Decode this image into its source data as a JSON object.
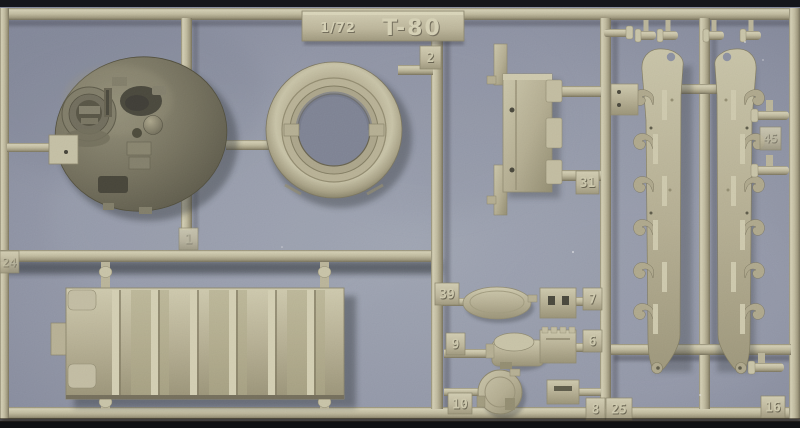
{
  "photo": {
    "subject": "Injection-molded plastic model kit sprue with T-80 tank parts on a gray-blue scanner background",
    "title_plate": {
      "scale": "1/72",
      "name": "T-80"
    },
    "part_tags": {
      "t1": "1",
      "t2": "2",
      "t6": "6",
      "t7": "7",
      "t8": "8",
      "t9": "9",
      "t10": "10",
      "t16": "16",
      "t24": "24",
      "t25": "25",
      "t31": "31",
      "t39": "39",
      "t45": "45"
    },
    "colors": {
      "background": "#8f94a5",
      "plastic": "#b7b194",
      "plastic_highlight": "#d6d1b3",
      "plastic_shadow": "#756f56",
      "turret_plastic": "#6c6853"
    },
    "parts": [
      "turret-roof",
      "turret-ring",
      "hull-rear-bulkhead",
      "ribbed-hull-plate",
      "side-skirt-left",
      "side-skirt-right",
      "oval-hatch",
      "commander-cupola",
      "round-hatch",
      "detail-box-7",
      "detail-box-6",
      "detail-box-8",
      "wheel-hub-pins",
      "mounting-plate"
    ]
  }
}
